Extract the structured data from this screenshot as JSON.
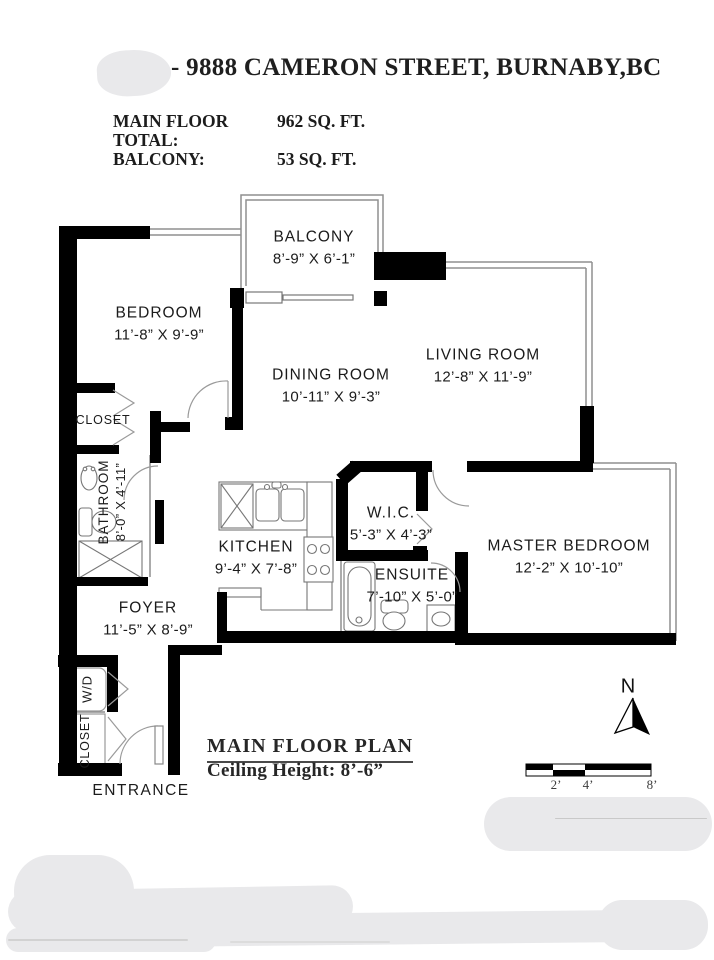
{
  "header": {
    "title": "- 9888 CAMERON STREET, BURNABY,BC",
    "areas": [
      {
        "label": "MAIN FLOOR TOTAL:",
        "value": "962 SQ. FT."
      },
      {
        "label": "BALCONY:",
        "value": "53 SQ. FT."
      }
    ]
  },
  "plan": {
    "rooms": [
      {
        "name": "BALCONY",
        "dims": "8’-9” X 6’-1”"
      },
      {
        "name": "BEDROOM",
        "dims": "11’-8” X 9’-9”"
      },
      {
        "name": "DINING ROOM",
        "dims": "10’-11” X 9’-3”"
      },
      {
        "name": "LIVING ROOM",
        "dims": "12’-8” X 11’-9”"
      },
      {
        "name": "KITCHEN",
        "dims": "9’-4” X 7’-8”"
      },
      {
        "name": "W.I.C.",
        "dims": "5’-3” X 4’-3”"
      },
      {
        "name": "ENSUITE",
        "dims": "7’-10” X 5’-0”"
      },
      {
        "name": "MASTER BEDROOM",
        "dims": "12’-2” X 10’-10”"
      },
      {
        "name": "FOYER",
        "dims": "11’-5” X 8’-9”"
      },
      {
        "name": "BATHROOM",
        "dims": "8’-0” X 4’-11”"
      }
    ],
    "labels": {
      "bedroom_closet": "CLOSET",
      "entry_closet": "CLOSET",
      "washer_dryer": "W/D",
      "entrance": "ENTRANCE"
    },
    "compass": {
      "north": "N"
    },
    "scale": {
      "ticks": [
        "2’",
        "4’",
        "8’"
      ]
    }
  },
  "footer": {
    "plan_title": "MAIN FLOOR PLAN",
    "ceiling_height": "Ceiling Height: 8’-6”"
  },
  "colors": {
    "wall": "#000000",
    "thin_line": "#8f8f8f",
    "text": "#1b1b1b",
    "redaction": "#e9e9eb"
  }
}
